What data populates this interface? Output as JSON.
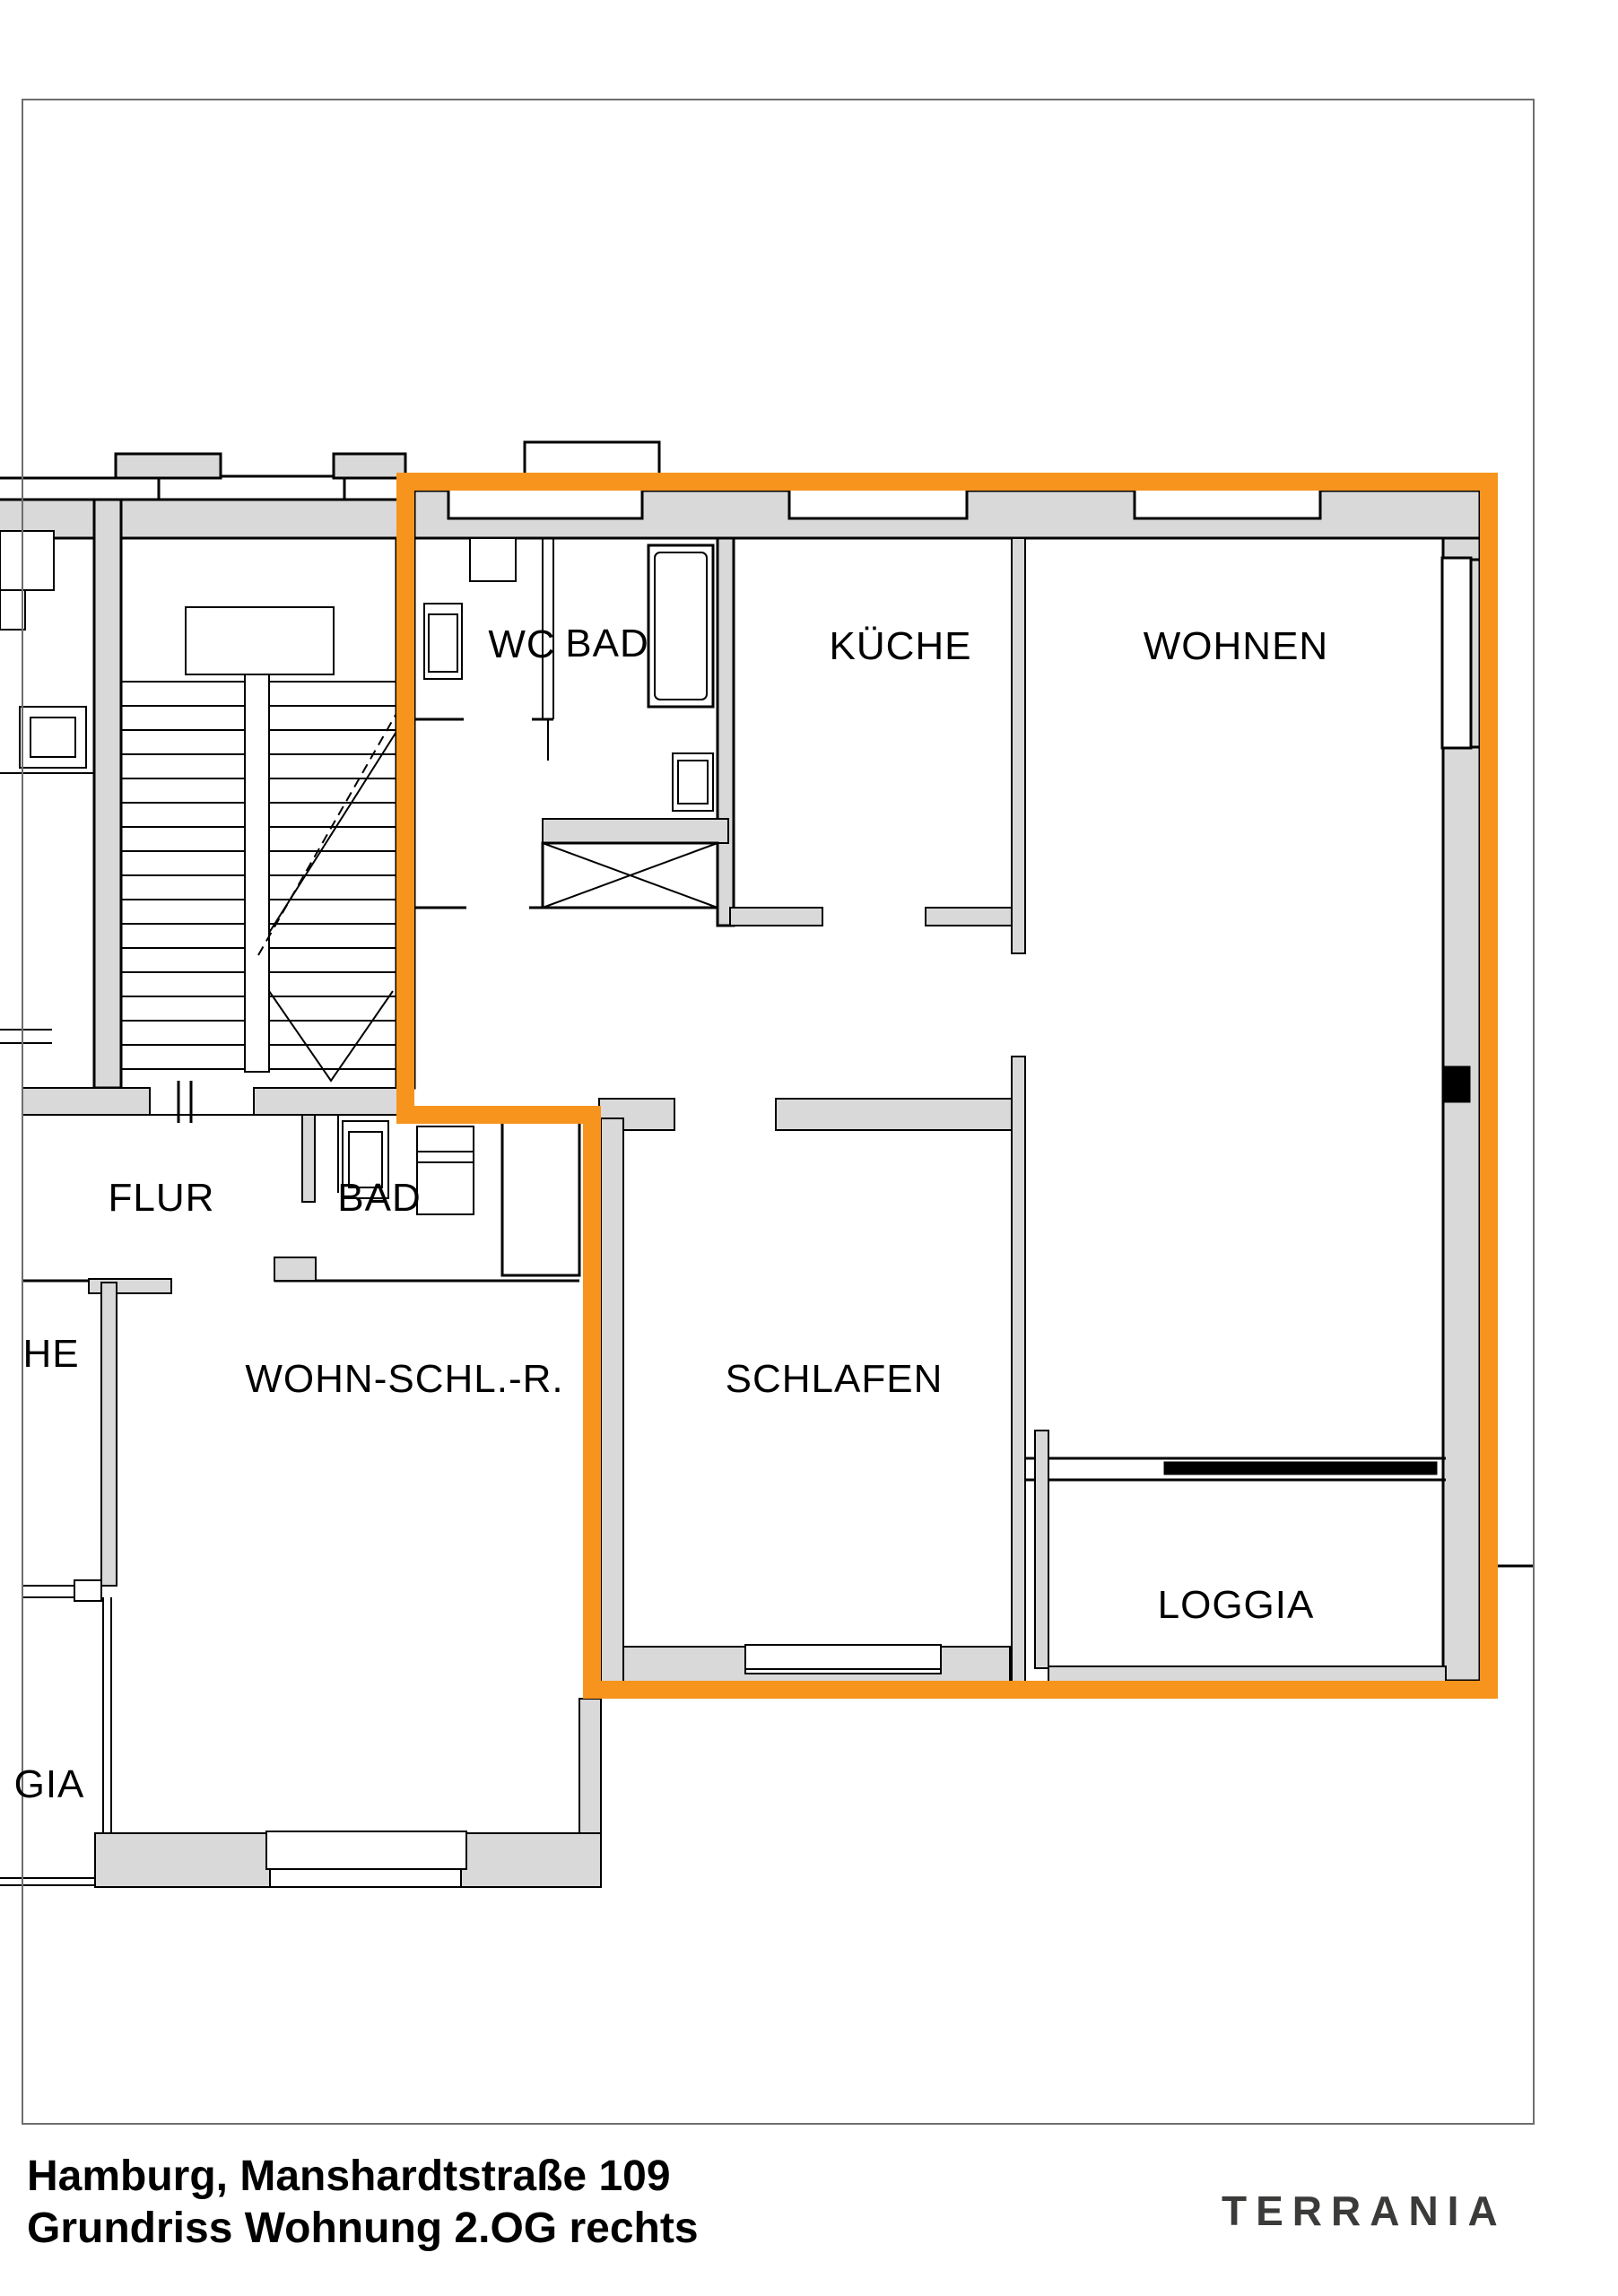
{
  "colors": {
    "highlight": "#F7941D",
    "wall_fill": "#D9D9D9",
    "page_frame": "#6e6e6e",
    "logo": "#3B3B39"
  },
  "floorplan": {
    "unit_highlighted": "Wohnung 2.OG rechts",
    "rooms": [
      {
        "id": "wc",
        "label": "WC"
      },
      {
        "id": "bad-upper",
        "label": "BAD"
      },
      {
        "id": "kueche",
        "label": "KÜCHE"
      },
      {
        "id": "wohnen",
        "label": "WOHNEN"
      },
      {
        "id": "flur",
        "label": "FLUR"
      },
      {
        "id": "bad-lower",
        "label": "BAD"
      },
      {
        "id": "wohn-schl-r",
        "label": "WOHN-SCHL.-R."
      },
      {
        "id": "schlafen",
        "label": "SCHLAFEN"
      },
      {
        "id": "loggia",
        "label": "LOGGIA"
      }
    ],
    "partial_labels": [
      {
        "id": "kueche-neighbor-clipped",
        "label": "HE"
      },
      {
        "id": "loggia-neighbor-clipped",
        "label": "GIA"
      }
    ]
  },
  "footer": {
    "address_line": "Hamburg, Manshardtstraße 109",
    "plan_line": "Grundriss Wohnung 2.OG rechts"
  },
  "branding": {
    "logo_text": "TERRANIA"
  }
}
